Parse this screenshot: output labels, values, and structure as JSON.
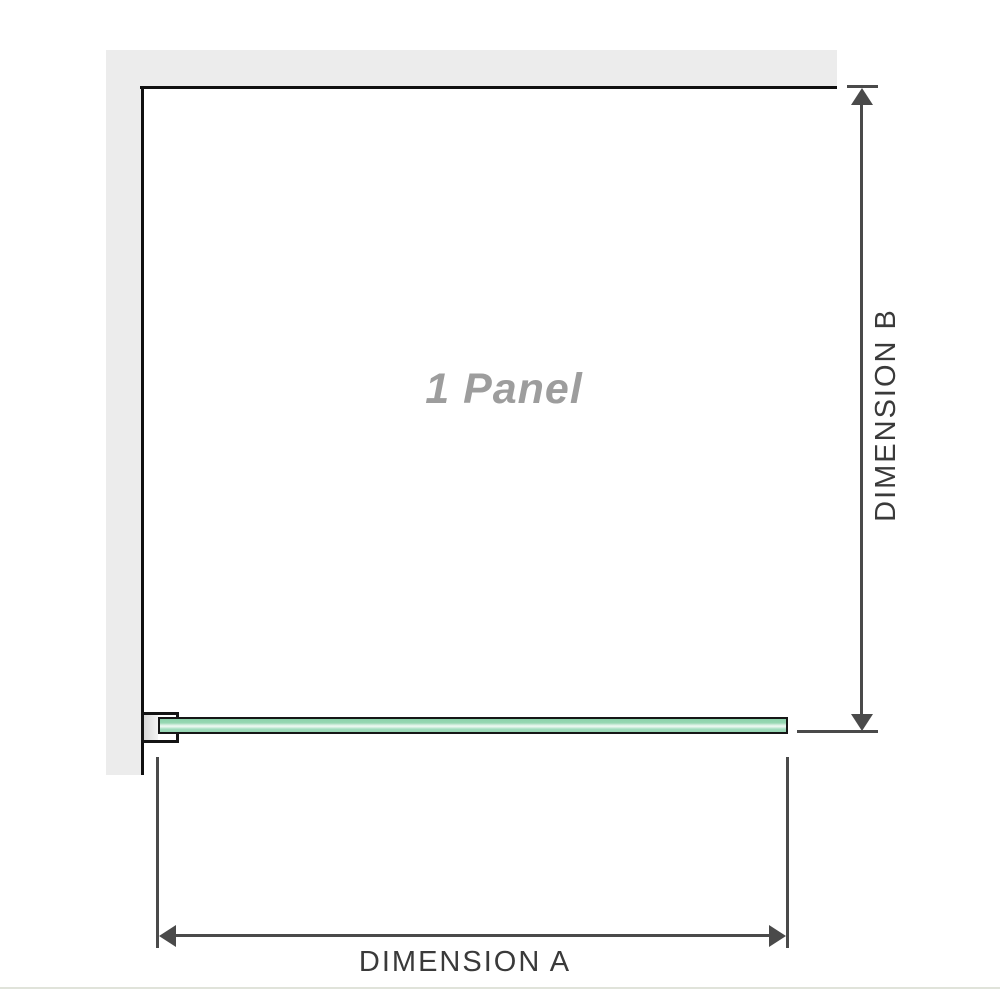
{
  "diagram": {
    "panel_label": "1 Panel",
    "dimensions": {
      "a_label": "DIMENSION A",
      "b_label": "DIMENSION B"
    },
    "colors": {
      "background": "#ffffff",
      "wall_gray": "#ececec",
      "panel_outline_black": "#101010",
      "dimension_gray": "#4a4a4a",
      "dimension_label_gray": "#3a3a3a",
      "glass_green": "#96d6b2",
      "glass_highlight": "#eef9f2",
      "panel_label_gray": "#9d9d9d",
      "page_edge_line": "#e0e3da"
    }
  }
}
